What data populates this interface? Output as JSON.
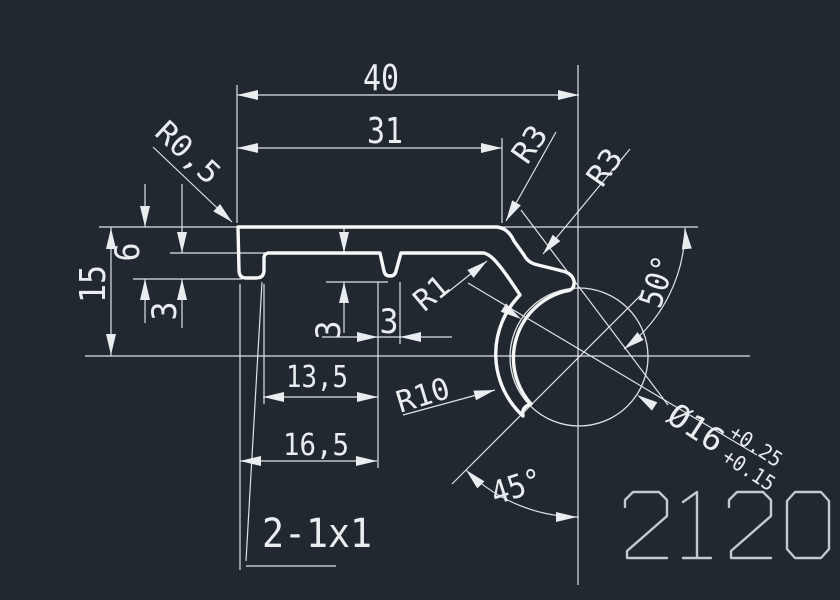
{
  "canvas": {
    "width": 840,
    "height": 600,
    "background": "#212830"
  },
  "colors": {
    "dimension_line": "#dfe3e6",
    "profile_line": "#f5f7f8",
    "stencil_text": "#c4c9cf"
  },
  "part_number": "2120",
  "labels": [
    {
      "name": "dim-40",
      "text": "40",
      "x": 381,
      "y": 90,
      "rot": 0,
      "fs": 36,
      "len": 36
    },
    {
      "name": "dim-31",
      "text": "31",
      "x": 385,
      "y": 143,
      "rot": 0,
      "fs": 36,
      "len": 36
    },
    {
      "name": "radius-r0-5",
      "text": "R0,5",
      "x": 181,
      "y": 160,
      "rot": 43,
      "fs": 30,
      "len": 76
    },
    {
      "name": "radius-r3-top",
      "text": "R3",
      "x": 538,
      "y": 150,
      "rot": -55,
      "fs": 30,
      "len": 38
    },
    {
      "name": "radius-r3-right",
      "text": "R3",
      "x": 613,
      "y": 173,
      "rot": -55,
      "fs": 30,
      "len": 38
    },
    {
      "name": "dim-15",
      "text": "15",
      "x": 105,
      "y": 284,
      "rot": -90,
      "fs": 36,
      "len": 38
    },
    {
      "name": "dim-6",
      "text": "6",
      "x": 139,
      "y": 252,
      "rot": -90,
      "fs": 34,
      "len": 19
    },
    {
      "name": "dim-3-left",
      "text": "3",
      "x": 176,
      "y": 311,
      "rot": -90,
      "fs": 34,
      "len": 19
    },
    {
      "name": "dim-3-groove-depth",
      "text": "3",
      "x": 340,
      "y": 330,
      "rot": -90,
      "fs": 34,
      "len": 19
    },
    {
      "name": "dim-3-groove-width",
      "text": "3",
      "x": 389,
      "y": 333,
      "rot": 0,
      "fs": 34,
      "len": 19
    },
    {
      "name": "dim-13-5",
      "text": "13,5",
      "x": 317,
      "y": 387,
      "rot": 0,
      "fs": 30,
      "len": 62
    },
    {
      "name": "dim-16-5",
      "text": "16,5",
      "x": 316,
      "y": 455,
      "rot": 0,
      "fs": 30,
      "len": 66
    },
    {
      "name": "radius-r1",
      "text": "R1",
      "x": 438,
      "y": 301,
      "rot": -40,
      "fs": 30,
      "len": 36
    },
    {
      "name": "radius-r10",
      "text": "R10",
      "x": 426,
      "y": 405,
      "rot": -17,
      "fs": 30,
      "len": 54
    },
    {
      "name": "angle-50",
      "text": "50°",
      "x": 668,
      "y": 285,
      "rot": -72,
      "fs": 32,
      "len": 52
    },
    {
      "name": "angle-45",
      "text": "45°",
      "x": 520,
      "y": 497,
      "rot": -18,
      "fs": 32,
      "len": 52
    },
    {
      "name": "dia-16",
      "text": "Ø16",
      "x": 690,
      "y": 437,
      "rot": 33,
      "fs": 32,
      "len": 60
    },
    {
      "name": "tolerance-upper",
      "text": "+0.25",
      "x": 752,
      "y": 452,
      "rot": 33,
      "fs": 21,
      "len": 58
    },
    {
      "name": "tolerance-lower",
      "text": "+0.15",
      "x": 745,
      "y": 476,
      "rot": 33,
      "fs": 21,
      "len": 58
    },
    {
      "name": "note-chamfer",
      "text": "2-1x1",
      "x": 317,
      "y": 547,
      "rot": 0,
      "fs": 40,
      "len": 110
    }
  ]
}
